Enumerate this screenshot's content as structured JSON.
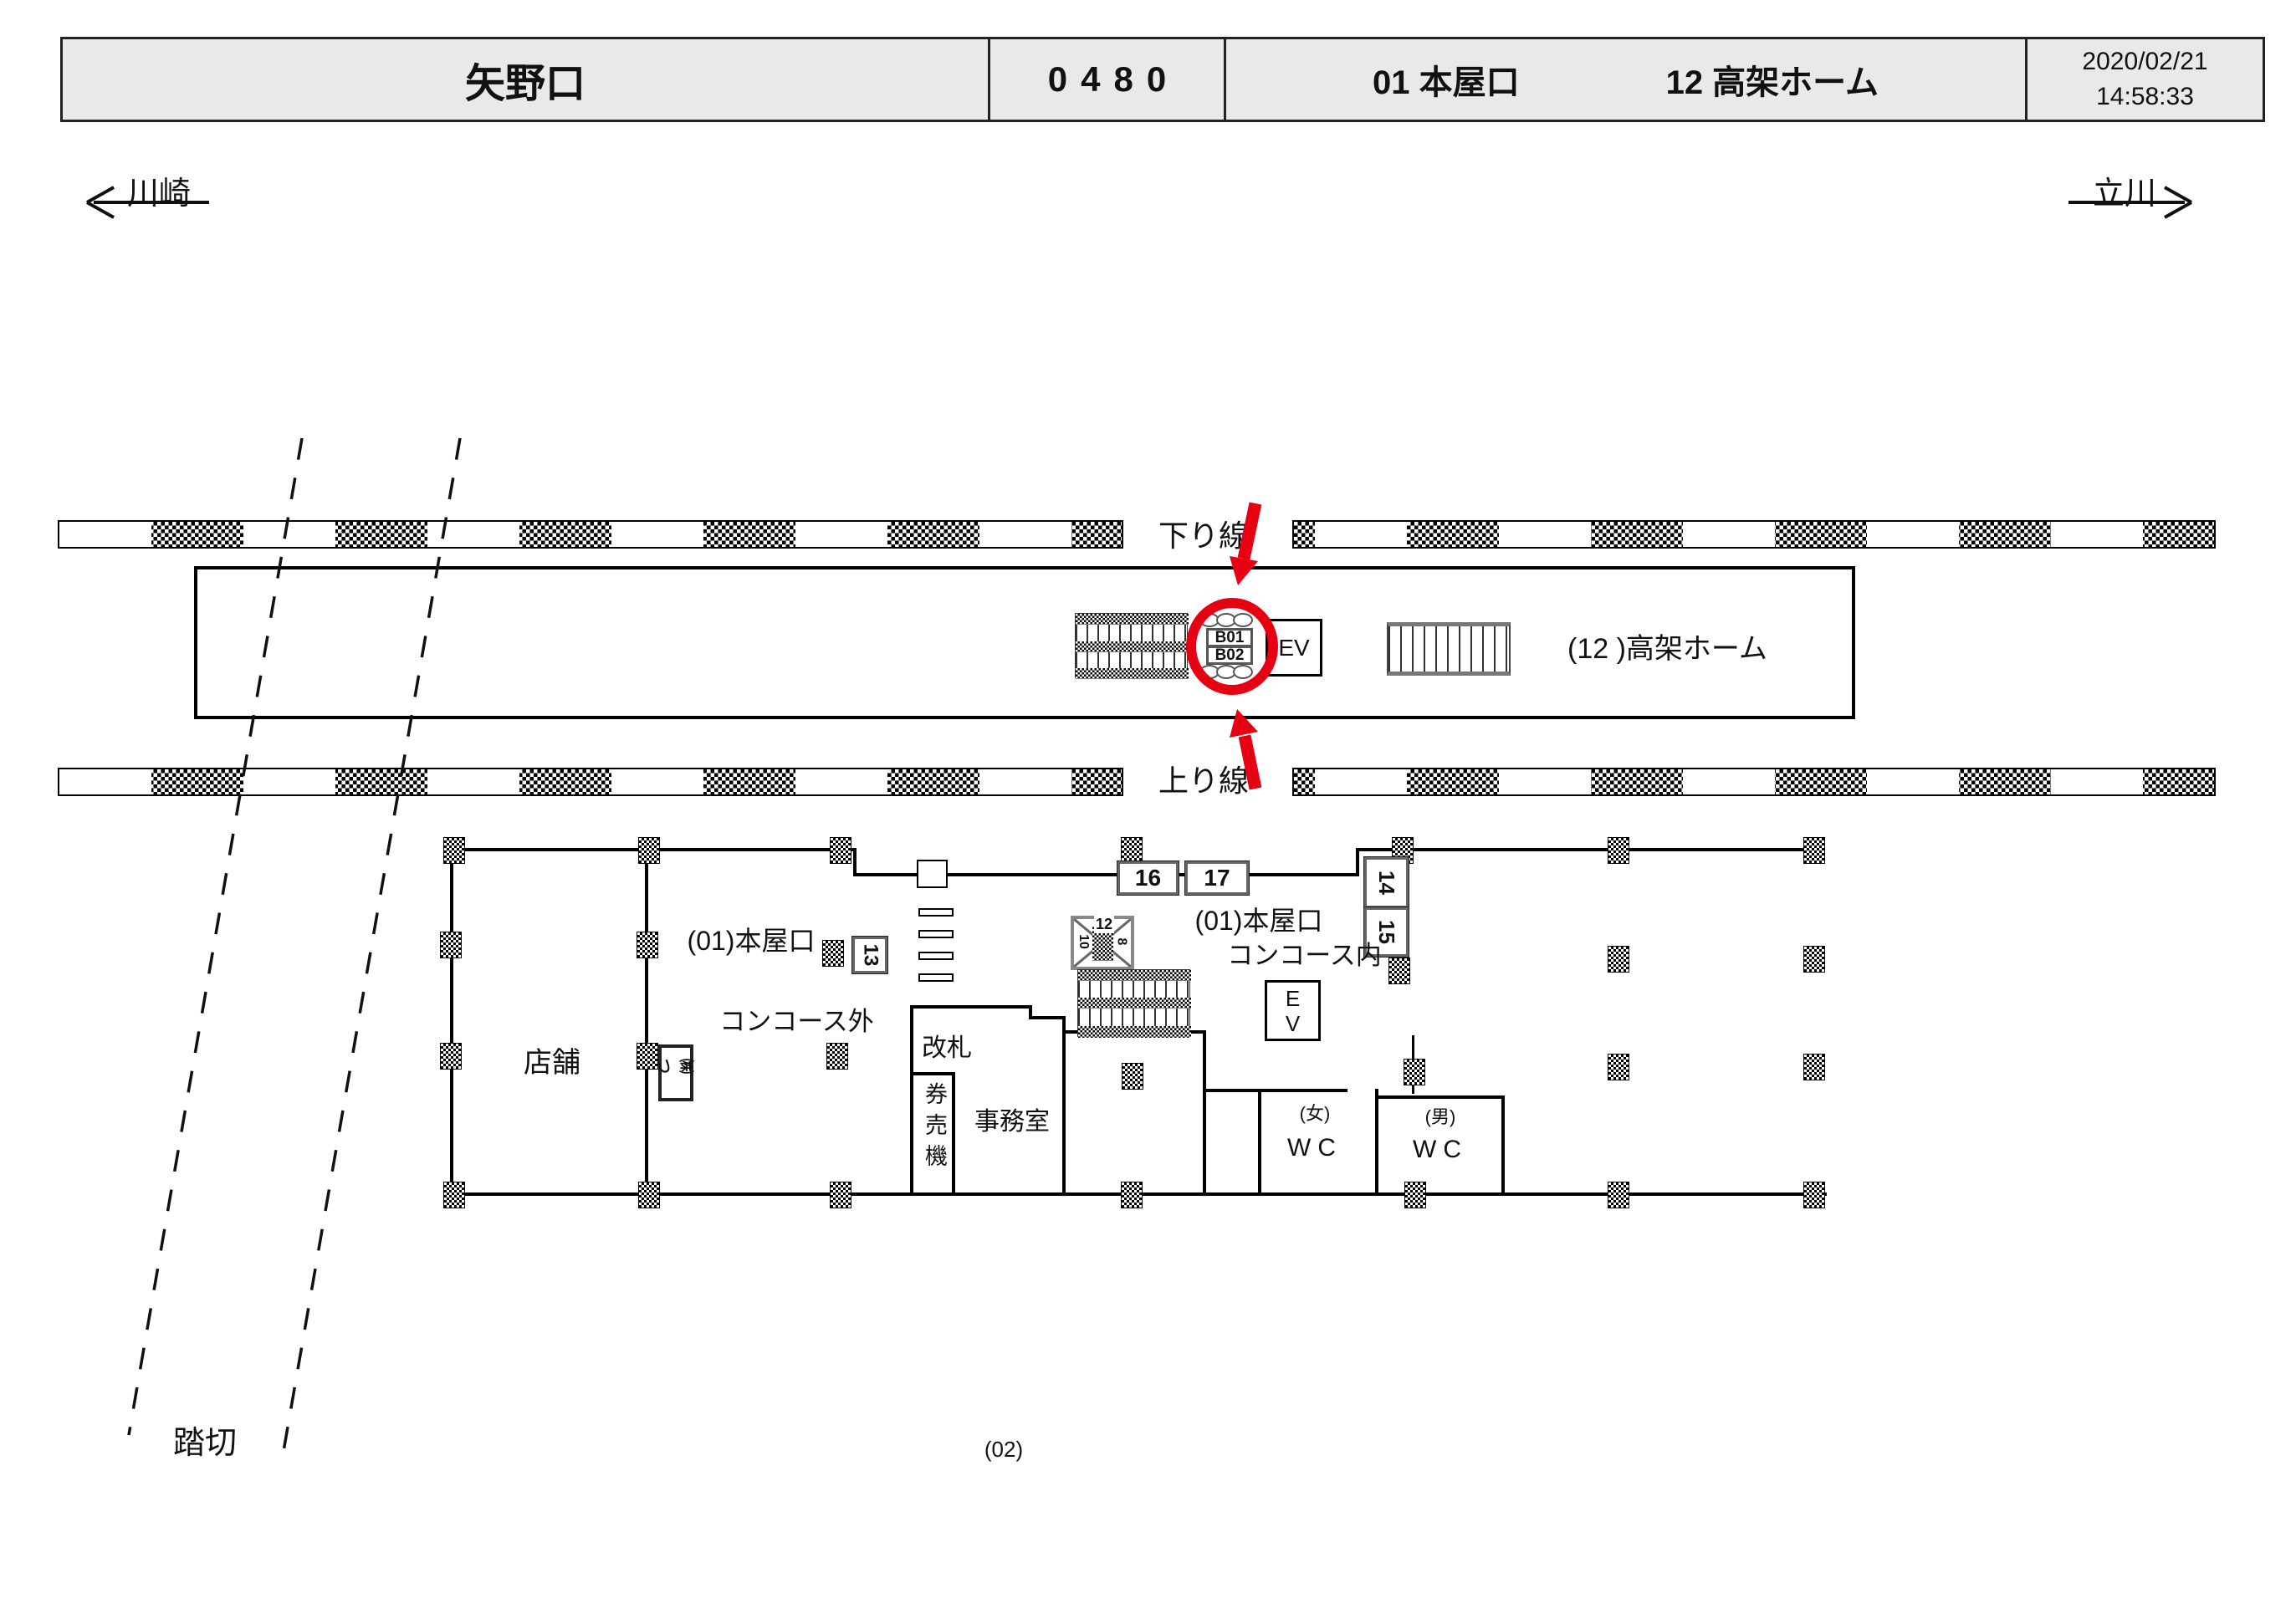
{
  "header": {
    "station": "矢野口",
    "code": "0480",
    "entrance_label": "01 本屋口",
    "platform_label": "12 高架ホーム",
    "date": "2020/02/21",
    "time": "14:58:33"
  },
  "directions": {
    "left": "川崎",
    "right": "立川"
  },
  "tracks": {
    "down": "下り線",
    "up": "上り線"
  },
  "platform": {
    "label": "(12 )高架ホーム",
    "ev": "EV",
    "b01": "B01",
    "b02": "B02"
  },
  "concourse": {
    "shop": "店舗",
    "entrance_out_title": "(01)本屋口",
    "concourse_out": "コンコース外",
    "gate": "改札",
    "ticket_machine": "券売機",
    "office": "事務室",
    "entrance_in_title": "(01)本屋口",
    "concourse_in": "コンコース内",
    "ev_e": "E",
    "ev_v": "V",
    "wc_female_tag": "(女)",
    "wc_female": "WC",
    "wc_male_tag": "(男)",
    "wc_male": "WC"
  },
  "signs": {
    "s13": "13",
    "s14": "14",
    "s15": "15",
    "s16": "16",
    "s17": "17",
    "x12": "12",
    "x10": "10",
    "x8": "8",
    "small": "㈱つ"
  },
  "misc": {
    "crossing": "踏切",
    "page": "(02)"
  },
  "colors": {
    "accent_red": "#e60012",
    "header_bg": "#e9e9e9"
  }
}
